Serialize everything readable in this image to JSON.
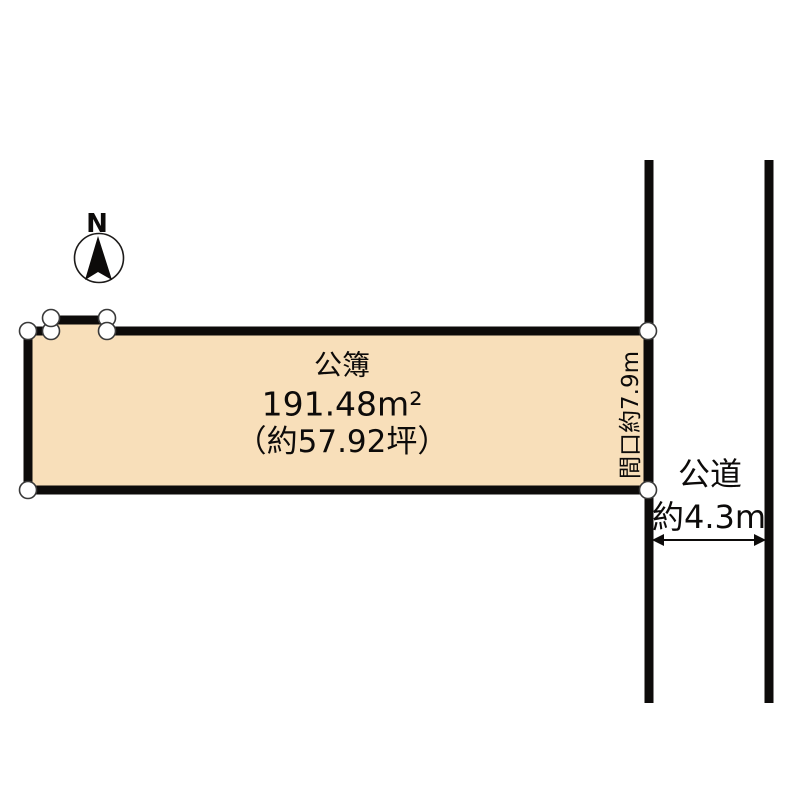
{
  "compass": {
    "north_label": "N"
  },
  "parcel": {
    "registry_label": "公簿",
    "area_sqm": "191.48m²",
    "area_tsubo": "（約57.92坪）",
    "frontage_label": "間口約7.9m"
  },
  "road": {
    "name_label": "公道",
    "width_label": "約4.3m"
  },
  "colors": {
    "parcel_fill": "#f8dfba",
    "outline": "#0d0b0a",
    "background": "#ffffff"
  }
}
